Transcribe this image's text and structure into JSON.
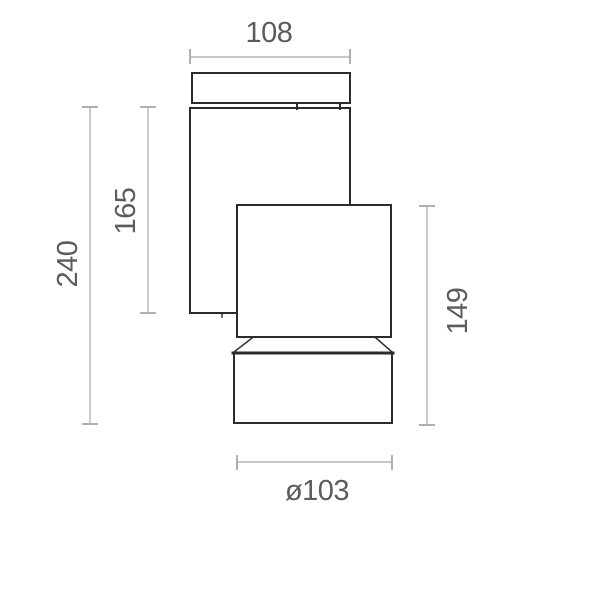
{
  "drawing": {
    "kind": "technical-dimension-drawing",
    "dimensions": {
      "top_width": "108",
      "bracket_height": "165",
      "overall_height": "240",
      "head_height": "149",
      "barrel_diameter": "ø103"
    },
    "colors": {
      "outline": "#2b2b2b",
      "dimension_line": "#a8a8a8",
      "dimension_text": "#5c5c5c",
      "background": "#ffffff"
    }
  }
}
